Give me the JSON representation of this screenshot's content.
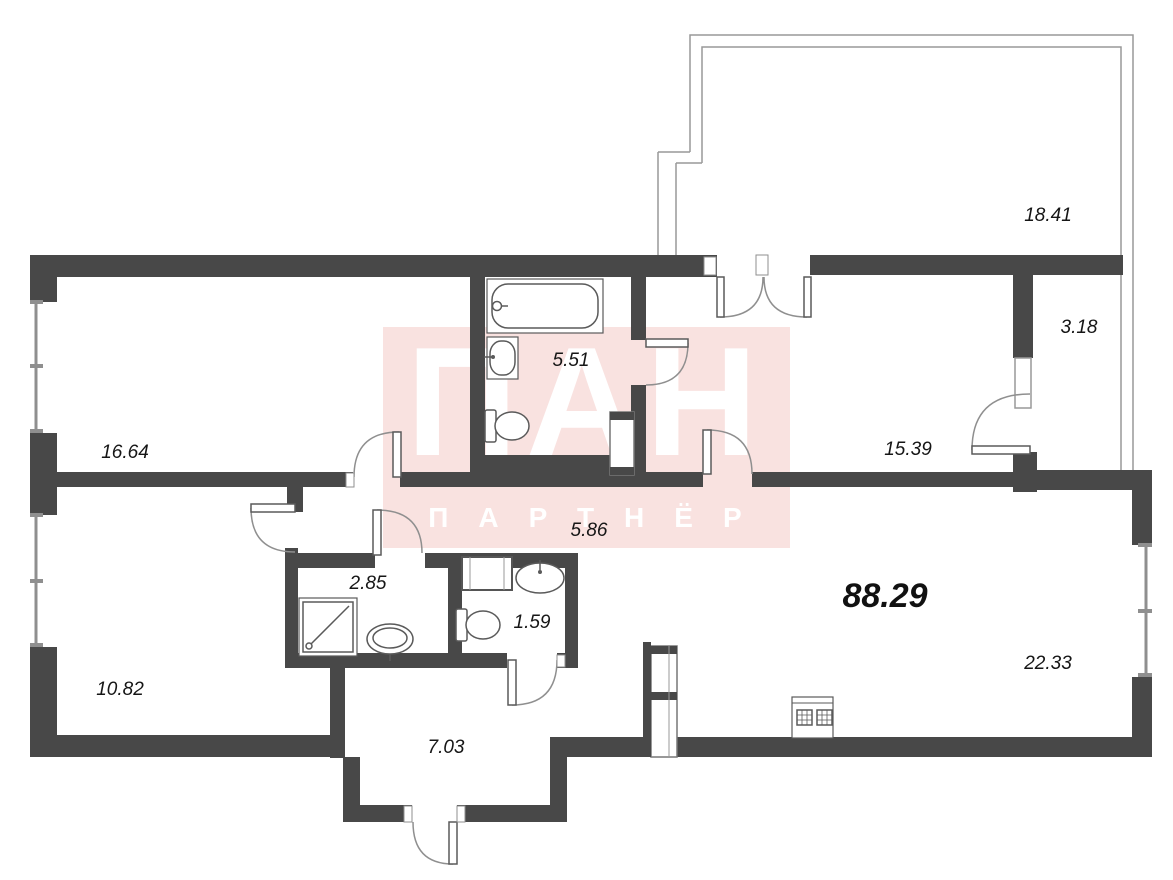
{
  "watermark": {
    "line1": "ПАН",
    "line2": "ПАРТНЁР",
    "field_color": "#f9e2e0",
    "text_color": "#ffffff"
  },
  "plan": {
    "total_area": "88.29",
    "rooms": [
      {
        "id": "balcony",
        "area": "18.41"
      },
      {
        "id": "closet",
        "area": "3.18"
      },
      {
        "id": "bedroom-top-left",
        "area": "16.64"
      },
      {
        "id": "bathroom",
        "area": "5.51"
      },
      {
        "id": "bedroom-right",
        "area": "15.39"
      },
      {
        "id": "corridor",
        "area": "5.86"
      },
      {
        "id": "shower-room",
        "area": "2.85"
      },
      {
        "id": "wc",
        "area": "1.59"
      },
      {
        "id": "room-bottom-left",
        "area": "10.82"
      },
      {
        "id": "hallway",
        "area": "7.03"
      },
      {
        "id": "living-kitchen",
        "area": "22.33"
      }
    ],
    "colors": {
      "wall": "#484848",
      "thin_line": "#8f8f8f",
      "fixture_line": "#5a5a5a",
      "label": "#161616"
    }
  }
}
